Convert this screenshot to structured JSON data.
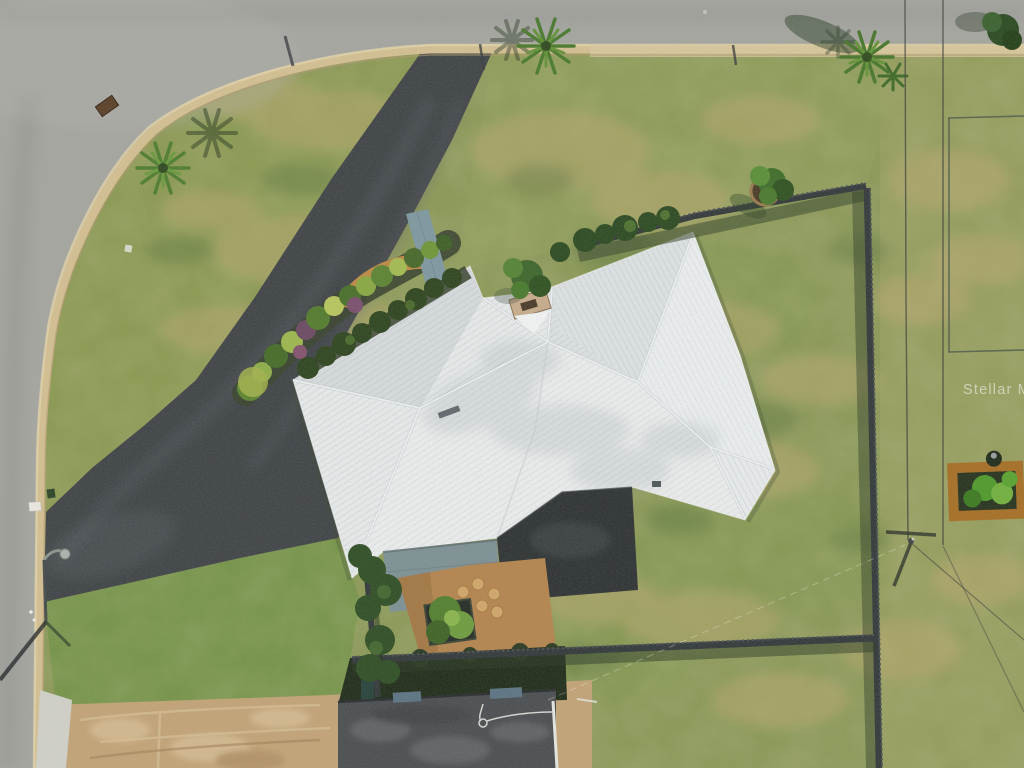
{
  "image": {
    "kind": "aerial-drone-photo",
    "subject": "single family home with white metal hip roof, long asphalt driveway, corner lot",
    "width_px": 1024,
    "height_px": 768
  },
  "watermark": {
    "text": "Stellar MLS"
  },
  "scene": {
    "elements": [
      {
        "name": "street-top",
        "note": "paved road along top edge"
      },
      {
        "name": "street-left",
        "note": "paved road along left edge, rounded corner"
      },
      {
        "name": "curb",
        "note": "tan mountable curb following both streets"
      },
      {
        "name": "driveway",
        "note": "dark asphalt driveway from top street to left street apron"
      },
      {
        "name": "main-roof",
        "note": "white corrugated metal hip roof"
      },
      {
        "name": "chimney",
        "note": "tan chimney in roof notch"
      },
      {
        "name": "lanai-roof-teal",
        "note": "slate-teal lower roof section"
      },
      {
        "name": "lanai-roof-dark",
        "note": "dark charcoal flat roof section"
      },
      {
        "name": "landscape-bed",
        "note": "plant bed along driveway with stone path"
      },
      {
        "name": "teal-walkway",
        "note": "blue-gray walkway to entry"
      },
      {
        "name": "patio-mulch",
        "note": "orange mulch patio with stepping stones and planter"
      },
      {
        "name": "back-fence",
        "note": "wood fence along rear of lot"
      },
      {
        "name": "right-fence",
        "note": "wood fence along right lot line"
      },
      {
        "name": "bottom-fence",
        "note": "wood fence along bottom of lot"
      },
      {
        "name": "palm-corner",
        "note": "palm tree on corner lawn"
      },
      {
        "name": "palm-driveway",
        "note": "palm tree at driveway entrance"
      },
      {
        "name": "palm-top-right",
        "note": "palm tree near right street frontage"
      },
      {
        "name": "ring-tree",
        "note": "young tree in circular bed by rear fence"
      },
      {
        "name": "garden-bed-right",
        "note": "raised garden bed on neighbor lot"
      },
      {
        "name": "utility-pole",
        "note": "utility pole with cross-arm shadow"
      },
      {
        "name": "power-lines",
        "note": "overhead wires running through right side"
      },
      {
        "name": "street-light",
        "note": "street light on left street with long shadow"
      },
      {
        "name": "mailbox",
        "note": "white mailbox at left curb"
      },
      {
        "name": "neighbor-roof",
        "note": "charcoal shingle roof of neighboring house at bottom"
      },
      {
        "name": "dirt-area",
        "note": "tan sandy ground at bottom left"
      },
      {
        "name": "stellar-mls-watermark",
        "note": "semi-transparent watermark at right edge"
      }
    ],
    "palette": {
      "road": "#a6a6a2",
      "curb": "#d5c093",
      "grass_base": "#879653",
      "grass_bright": "#6d9142",
      "grass_tan_patch": "#b9a96f",
      "driveway": "#3f4347",
      "roof_white": "#e9eced",
      "roof_teal": "#7e9196",
      "roof_dark": "#2e3234",
      "neighbor_roof": "#4b4e52",
      "patio_mulch": "#b5854f",
      "dirt": "#c4a478",
      "fence": "#33383b",
      "foliage_dark": "#2e441f",
      "foliage_light": "#8fae4a",
      "watermark_fill": "rgba(255,255,255,0.52)"
    }
  }
}
